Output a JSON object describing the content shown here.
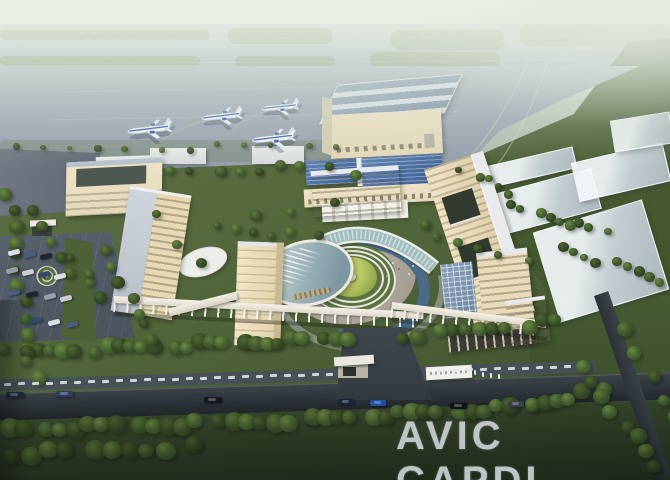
{
  "watermark": {
    "text": "AVIC CAPDI"
  },
  "scene": {
    "type": "architectural aerial rendering",
    "subject": "AVIC CAPDI institute campus beside an airport apron",
    "time_of_day": "hazy dusk",
    "airport": {
      "aircraft_count": 4,
      "aircraft_livery": "white fuselage with blue stripe",
      "features": [
        "runway",
        "grass infield strips",
        "taxiway markings",
        "concrete apron",
        "large hangar with ribbed roof"
      ]
    },
    "campus": {
      "features": [
        "central circular lawn with concentric terraces",
        "crescent water pool",
        "curved glass atrium building",
        "oval auditorium with louvered glass roof",
        "beige office slab buildings",
        "long colonnade walkway",
        "gatehouse and entrance plaza",
        "roadside sign wall",
        "surface parking with cars",
        "tree-lined perimeter roads",
        "translucent future-phase building masses"
      ]
    }
  },
  "colors": {
    "haze_top": "#ecf1e6",
    "runway_gray": "#a9b5c4",
    "taxiway_gray": "#9dabbb",
    "apron_light": "#a8b2c0",
    "apron_dark": "#8f9aa9",
    "grass_strip": "#7d8c66",
    "field_green_light": "#5b6c44",
    "field_green_dark": "#3f5229",
    "campus_lawn": "#53673c",
    "tree_light": "#5f7a3c",
    "tree_dark": "#2a3d1f",
    "beige_lit": "#f0e4c6",
    "beige": "#e4d8ba",
    "beige_shade": "#c9ba92",
    "roof_light": "#e7eaec",
    "roof_slate": "#8ea3b8",
    "glass_panel": "#3d5e92",
    "glass_teal": "#9fbdbd",
    "water": "#4a6a88",
    "court_lawn_light": "#dfe187",
    "court_lawn_dark": "#8ea74b",
    "ring_white": "#e7e8e0",
    "road_dark": "#23292e",
    "parking_gray": "#49525c",
    "plane_white": "#f5f8fb",
    "plane_blue": "#3e63b0",
    "watermark_gray": "#c7ccd0"
  }
}
